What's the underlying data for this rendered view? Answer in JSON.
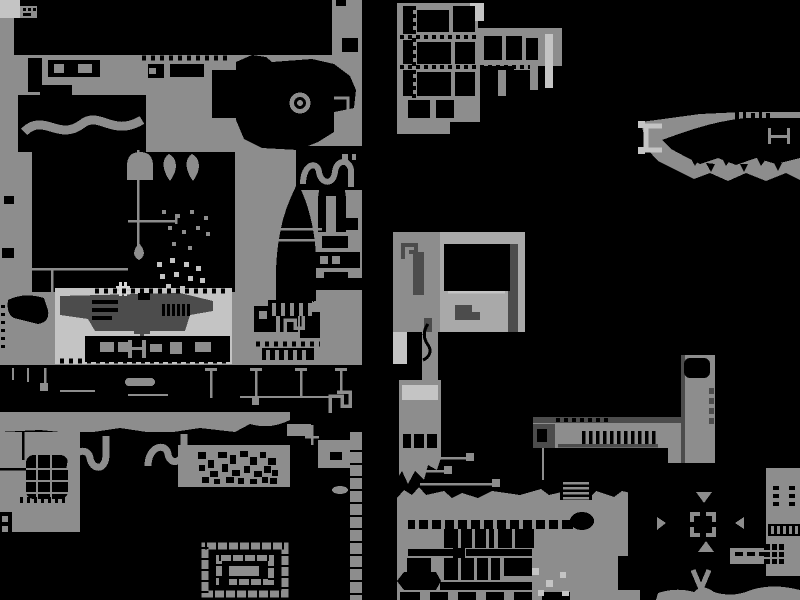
{
  "screen": {
    "kind": "monochrome game world map",
    "width": 800,
    "height": 600
  },
  "palette": {
    "ink": "#000000",
    "terrain": "#8d8d8d",
    "midlight": "#a9a9a9",
    "light": "#c4c4c4",
    "dark": "#4c4c4c",
    "bright": "#d6d6d6"
  },
  "landmarks": [
    "ring-landmark",
    "spike-tower",
    "spiral-chamber",
    "factory-platform",
    "conveyor-corridor",
    "dpad-arrows",
    "chevron-exit",
    "ladder",
    "antenna-wires",
    "rubble-field",
    "net-grid-block",
    "snake-tubes",
    "hanging-droplet"
  ]
}
